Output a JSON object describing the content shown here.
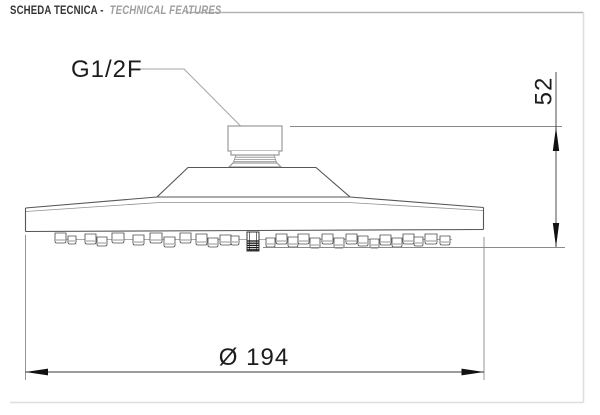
{
  "header": {
    "title_it": "SCHEDA TECNICA -",
    "title_en": "TECHNICAL FEATURES"
  },
  "diagram": {
    "labels": {
      "connection": "G1/2F",
      "height": "52",
      "diameter": "Ø 194"
    },
    "dimensions": {
      "height_mm": 52,
      "diameter_mm": 194,
      "thread": "G1/2F"
    },
    "nozzles": [
      [
        55,
        233,
        11,
        10
      ],
      [
        68,
        236,
        8,
        8
      ],
      [
        85,
        234,
        11,
        10
      ],
      [
        97,
        237,
        10,
        9
      ],
      [
        112,
        233,
        12,
        10
      ],
      [
        133,
        235,
        11,
        10
      ],
      [
        150,
        233,
        12,
        10
      ],
      [
        164,
        237,
        11,
        10
      ],
      [
        180,
        233,
        11,
        10
      ],
      [
        196,
        234,
        11,
        11
      ],
      [
        208,
        238,
        10,
        9
      ],
      [
        220,
        235,
        11,
        10
      ],
      [
        231,
        236,
        8,
        9
      ],
      [
        266,
        238,
        9,
        9
      ],
      [
        276,
        234,
        11,
        10
      ],
      [
        288,
        237,
        10,
        10
      ],
      [
        298,
        234,
        11,
        10
      ],
      [
        310,
        238,
        10,
        10
      ],
      [
        322,
        234,
        11,
        10
      ],
      [
        334,
        238,
        10,
        10
      ],
      [
        346,
        234,
        11,
        10
      ],
      [
        358,
        236,
        10,
        10
      ],
      [
        370,
        239,
        9,
        9
      ],
      [
        380,
        235,
        11,
        10
      ],
      [
        392,
        238,
        10,
        9
      ],
      [
        403,
        234,
        11,
        10
      ],
      [
        414,
        237,
        9,
        9
      ],
      [
        425,
        234,
        12,
        10
      ],
      [
        440,
        236,
        10,
        9
      ]
    ],
    "center_nozzle": {
      "x": 247,
      "y": 232,
      "w": 12,
      "h": 19,
      "stripes": [
        241,
        243.2,
        245.4,
        247.6,
        249.8
      ]
    }
  },
  "colors": {
    "outline": "#565656",
    "secondary": "#8f8f8f",
    "dimension": "#3a3a3a",
    "frame": "#dedede",
    "text": "#1c1c1c"
  }
}
